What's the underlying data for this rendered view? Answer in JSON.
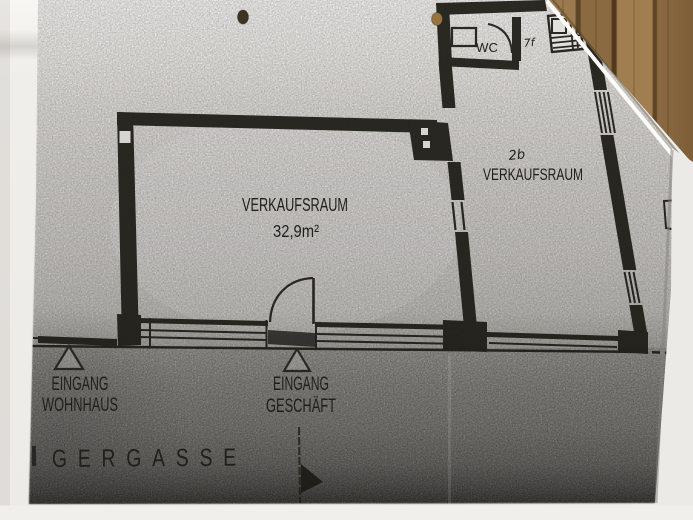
{
  "photo": {
    "subject": "floor plan photocopy on wooden table",
    "colors": {
      "ink": "#1b1a18",
      "paper": "#f0eeea",
      "scan_light": "#e9e7e3",
      "scan_street_dark": "#343330",
      "wood": "#8a6a42",
      "pencil": "#77766f"
    },
    "symbols": {
      "entrance_marker": "triangle-outline",
      "direction_arrow": "flag-arrow-down",
      "punched_holes": 2
    }
  },
  "floor_plan": {
    "main_room": {
      "label": "VERKAUFSRAUM",
      "area": "32,9m²"
    },
    "right_room": {
      "label": "VERKAUFSRAUM",
      "note": "2b"
    },
    "wc": {
      "label": "WC",
      "note": "7f"
    },
    "entrance_house": {
      "line1": "EINGANG",
      "line2": "WOHNHAUS"
    },
    "entrance_shop": {
      "line1": "EINGANG",
      "line2": "GESCHÄFT"
    },
    "street": {
      "label": "GERGASSE"
    }
  }
}
